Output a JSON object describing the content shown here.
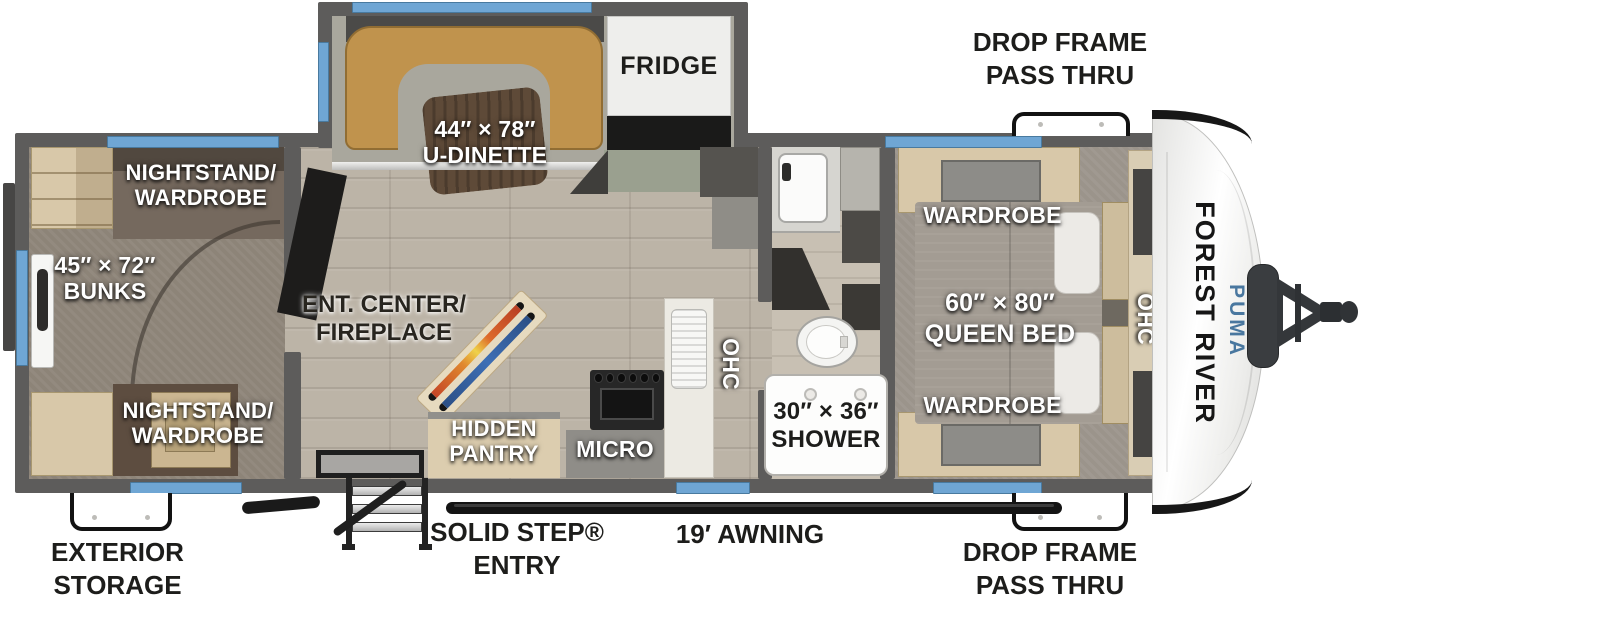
{
  "title": "Forest River Puma travel trailer floor plan",
  "brand": {
    "manufacturer": "FOREST RIVER",
    "model": "PUMA",
    "model_tagline": "TRAILERS"
  },
  "callouts": {
    "drop_frame_top": [
      "DROP FRAME",
      "PASS THRU"
    ],
    "drop_frame_bottom": [
      "DROP FRAME",
      "PASS THRU"
    ],
    "exterior_storage": [
      "EXTERIOR",
      "STORAGE"
    ],
    "solid_step_entry": [
      "SOLID STEP®",
      "ENTRY"
    ],
    "awning": "19′ AWNING"
  },
  "features": {
    "dinette": [
      "44″ × 78″",
      "U-DINETTE"
    ],
    "fridge": "FRIDGE",
    "nightstand_wardrobe_top": [
      "NIGHTSTAND/",
      "WARDROBE"
    ],
    "bunks": [
      "45″ × 72″",
      "BUNKS"
    ],
    "nightstand_wardrobe_bottom": [
      "NIGHTSTAND/",
      "WARDROBE"
    ],
    "ent_center_fireplace": [
      "ENT. CENTER/",
      "FIREPLACE"
    ],
    "hidden_pantry": [
      "HIDDEN",
      "PANTRY"
    ],
    "micro": "MICRO",
    "ohc_kitchen": "OHC",
    "shower": [
      "30″ × 36″",
      "SHOWER"
    ],
    "wardrobe_top": "WARDROBE",
    "queen_bed": [
      "60″ × 80″",
      "QUEEN BED"
    ],
    "wardrobe_bottom": "WARDROBE",
    "ohc_front": "OHC"
  },
  "colors": {
    "window_blue": "#6fa6d4",
    "wall_gray": "#5d5c5b",
    "dinette_tan": "#c0934d",
    "brand_blue": "#49779f",
    "floor_wood": "#bcb4a7",
    "bunk_carpet": "#8d8478",
    "bedroom_carpet": "#9b948b"
  }
}
